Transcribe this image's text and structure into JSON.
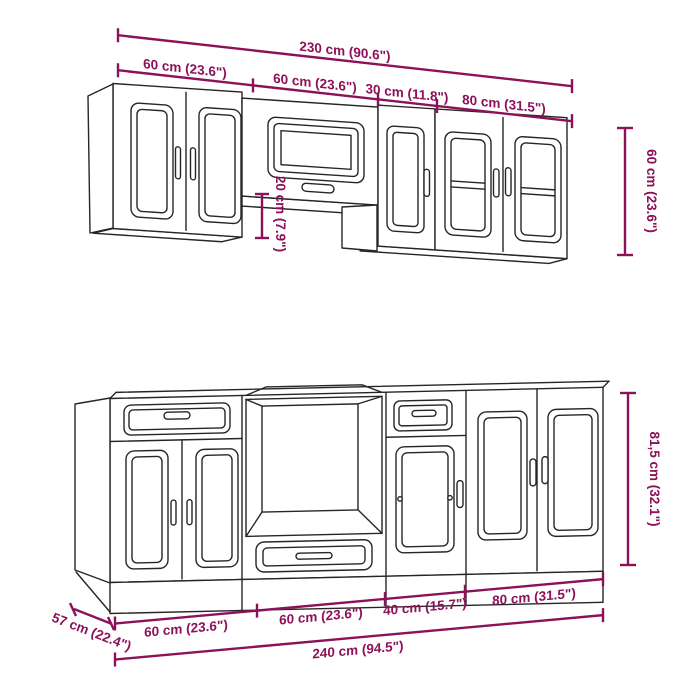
{
  "diagram_type": "kitchen-cabinet-set-dimension-drawing",
  "colors": {
    "dimension": "#8C1159",
    "ink": "#262626",
    "background": "#FFFFFF"
  },
  "upper": {
    "total": "230 cm (90.6\")",
    "segments": [
      "60 cm (23.6\")",
      "60 cm (23.6\")",
      "30 cm (11.8\")",
      "80 cm (31.5\")"
    ],
    "height": "60 cm (23.6\")",
    "gap": "20 cm (7.9\")"
  },
  "lower": {
    "total": "240 cm (94.5\")",
    "segments": [
      "60 cm (23.6\")",
      "60 cm (23.6\")",
      "40 cm (15.7\")",
      "80 cm (31.5\")"
    ],
    "height": "81,5 cm (32.1\")",
    "depth": "57 cm (22.4\")"
  }
}
